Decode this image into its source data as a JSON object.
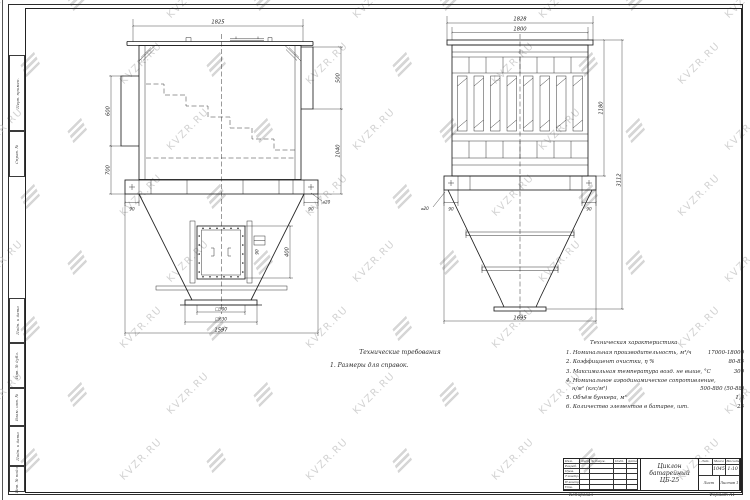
{
  "watermark": {
    "text": "KVZR.RU"
  },
  "tech_req": {
    "title": "Технические требования",
    "item": "1. Размеры для справок."
  },
  "tech_char": {
    "title": "Техническая характеристика",
    "items": [
      {
        "label": "1. Номинальная производительность, м³/ч",
        "value": "17000-18000"
      },
      {
        "label": "2. Коэффициент очистки, η %",
        "value": "80-85"
      },
      {
        "label": "3. Максимальная температура возд. не выше, °С",
        "value": "300"
      },
      {
        "label": "4. Номинальное аэродинамическое сопротивление,",
        "label2": "н/м² (кгс/м²)",
        "value": "500-880 (50-88)"
      },
      {
        "label": "5. Объём бункера, м³",
        "value": "1,8"
      },
      {
        "label": "6. Количество элементов в батарее, шт.",
        "value": "25"
      }
    ]
  },
  "left_view": {
    "dim_width_top": "1825",
    "dim_inlet_height": "600",
    "dim_left_lower": "700",
    "dim_right_upper": "500",
    "dim_right_lower": "1040",
    "hole_note": "⌀20",
    "dim_flange_left": "90",
    "dim_flange_right": "90",
    "dim_door_height": "400",
    "dim_fitting": "90",
    "dim_outlet_inner": "□500",
    "dim_outlet_outer": "□630",
    "dim_total_width": "1597"
  },
  "right_view": {
    "dim_width_outer": "1828",
    "dim_width_inner": "1800",
    "dim_height_upper": "1180",
    "dim_height_total": "3112",
    "dim_width_bottom": "1695",
    "dim_flange_left": "90",
    "dim_flange_right": "90",
    "hole_note": "⌀20"
  },
  "margin": {
    "items": [
      "Перв. примен.",
      "Справ. №",
      "Подп. и дата",
      "Инв. № дубл.",
      "Взам. инв. №",
      "Подп. и дата",
      "Инв. № подл."
    ]
  },
  "title_block": {
    "product": {
      "line1": "Циклон",
      "line2": "батарейный",
      "line3": "ЦБ-25"
    },
    "header_cells": [
      "Изм.",
      "Лист",
      "№ докум.",
      "Подп.",
      "Дата"
    ],
    "row_labels": [
      "Разраб.",
      "Пров.",
      "Т.контр.",
      "Н.контр.",
      "Утв."
    ],
    "lit_label": "Лит.",
    "mass_label": "Масса",
    "scale_label": "Масштаб",
    "mass_value": "1045",
    "scale_value": "1:10",
    "sheet_label": "Лист",
    "sheets_label": "Листов 1",
    "copied_label": "Копировал",
    "format_label": "Формат А1"
  },
  "colors": {
    "line": "#1f1f1f",
    "watermark": "#b7b7b7",
    "paper": "#ffffff"
  }
}
